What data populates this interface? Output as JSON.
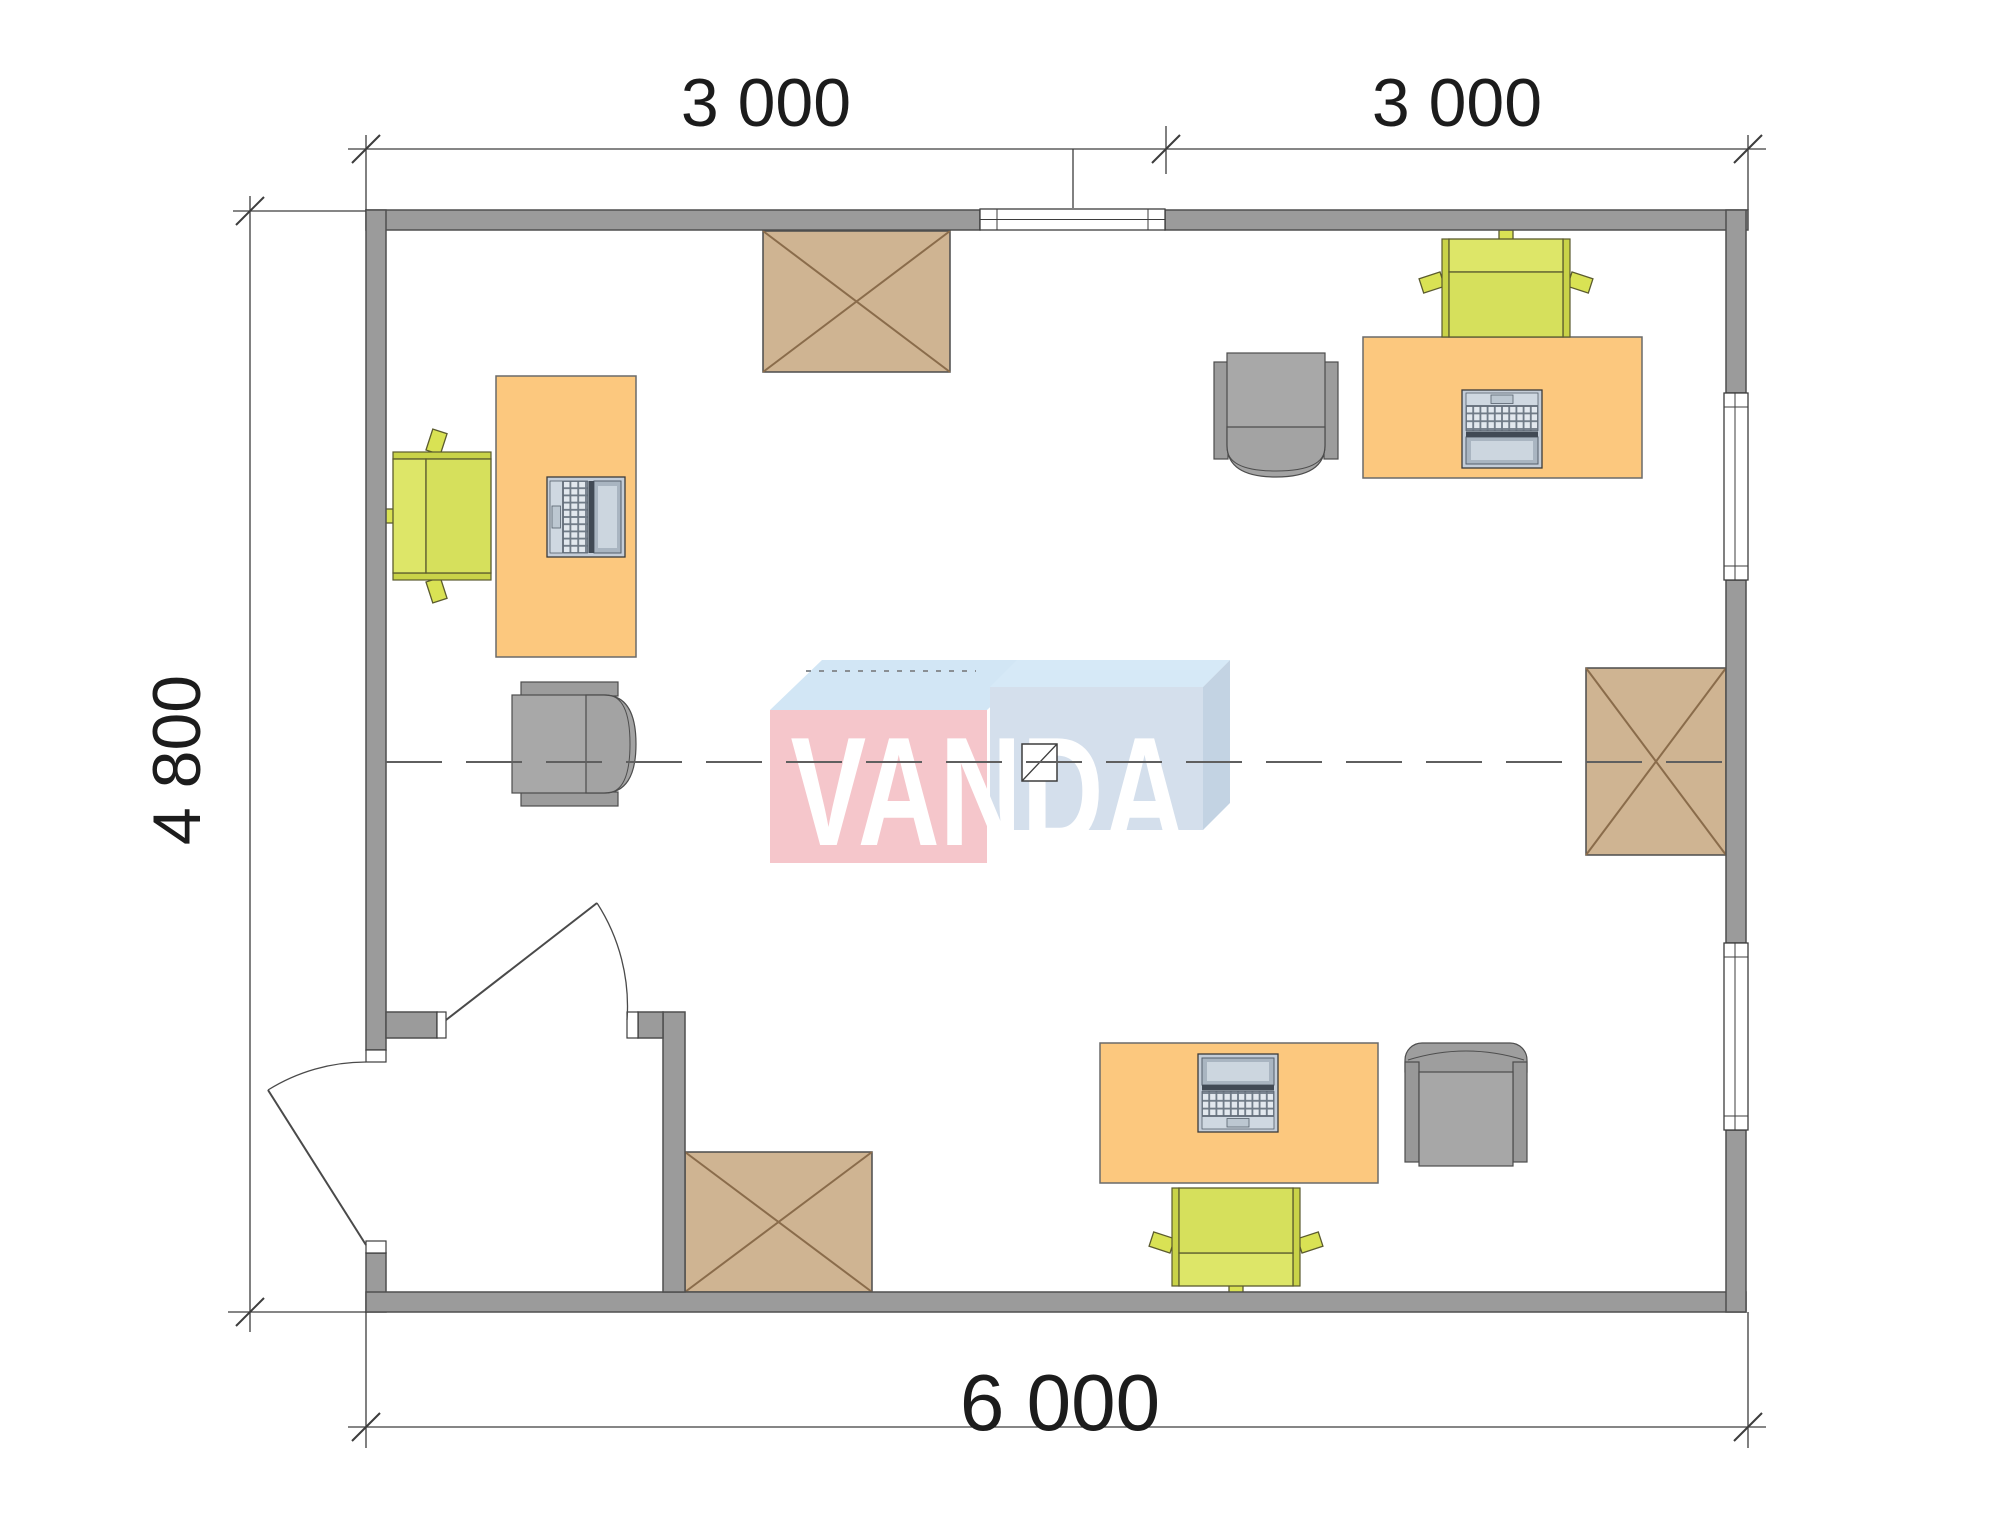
{
  "plan": {
    "title": "office-floor-plan",
    "dimensions": {
      "top_left_label": "3 000",
      "top_right_label": "3 000",
      "left_label": "4 800",
      "bottom_label": "6 000"
    },
    "watermark": {
      "text": "VANDA",
      "left_box_color": "#f5c6cb",
      "right_box_color": "#d4dfec",
      "top_face_color": "#d6e9f7",
      "letter_color": "#ffffff"
    },
    "colors": {
      "wall": "#9b9b9b",
      "desk": "#fcc87e",
      "task_chair_green": "#d6e05c",
      "visitor_chair_gray": "#a8a8a8",
      "storage_box_tan": "#cfb492",
      "background": "#ffffff",
      "dimension_lines": "#3d3d3d"
    },
    "furniture": [
      {
        "type": "desk-with-laptop",
        "location": "top-left"
      },
      {
        "type": "task-chair-green",
        "location": "left-of-top-left-desk"
      },
      {
        "type": "visitor-chair-gray",
        "location": "below-top-left-desk"
      },
      {
        "type": "desk-with-laptop",
        "location": "top-right"
      },
      {
        "type": "task-chair-green",
        "location": "above-top-right-desk"
      },
      {
        "type": "visitor-chair-gray",
        "location": "left-of-top-right-desk"
      },
      {
        "type": "desk-with-laptop",
        "location": "bottom-center"
      },
      {
        "type": "task-chair-green",
        "location": "below-bottom-desk"
      },
      {
        "type": "armchair-gray",
        "location": "right-of-bottom-desk"
      },
      {
        "type": "crossed-storage-box",
        "location": "top-center"
      },
      {
        "type": "crossed-storage-box",
        "location": "right-middle"
      },
      {
        "type": "crossed-storage-box",
        "location": "bottom-left"
      }
    ],
    "openings": [
      {
        "type": "window",
        "wall": "top"
      },
      {
        "type": "window",
        "wall": "right-upper"
      },
      {
        "type": "window",
        "wall": "right-lower"
      },
      {
        "type": "door",
        "wall": "left",
        "swing": "outward"
      },
      {
        "type": "door",
        "wall": "vestibule-partition",
        "swing": "into-room"
      }
    ]
  }
}
